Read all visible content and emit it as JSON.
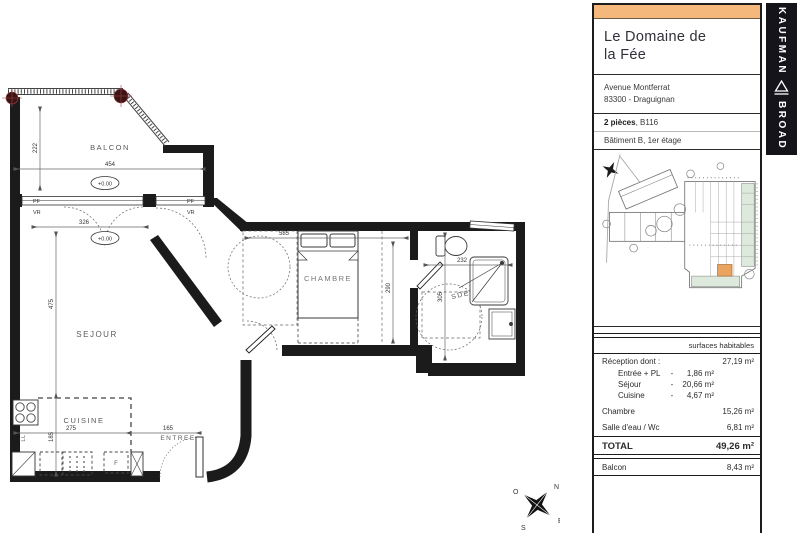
{
  "panel": {
    "title_line1": "Le Domaine de",
    "title_line2": "la Fée",
    "address_line1": "Avenue Montferrat",
    "address_line2": "83300 - Draguignan",
    "unit_type": "2 pièces",
    "unit_ref": ", B116",
    "unit_location": "Bâtiment B, 1er étage",
    "accent_color": "#F4B77C"
  },
  "brand": {
    "top": "KAUFMAN",
    "bottom": "BROAD"
  },
  "surfaces": {
    "header": "surfaces habitables",
    "reception": {
      "label": "Réception dont :",
      "value": "27,19 m²"
    },
    "sub": [
      {
        "label": "Entrée + PL",
        "dash": "-",
        "value": "1,86 m²"
      },
      {
        "label": "Séjour",
        "dash": "-",
        "value": "20,66 m²"
      },
      {
        "label": "Cuisine",
        "dash": "-",
        "value": "4,67 m²"
      }
    ],
    "rows": [
      {
        "label": "Chambre",
        "value": "15,26 m²"
      },
      {
        "label": "Salle d'eau / Wc",
        "value": "6,81 m²"
      }
    ],
    "total": {
      "label": "TOTAL",
      "value": "49,26 m²"
    },
    "balcony": {
      "label": "Balcon",
      "value": "8,43 m²"
    }
  },
  "floorplan": {
    "room_balcon": "BALCON",
    "room_sejour": "SEJOUR",
    "room_cuisine": "CUISINE",
    "room_entree": "ENTREE",
    "room_chambre": "CHAMBRE",
    "room_sde": "SDE",
    "dim_balcon_w": "454",
    "dim_balcon_d": "222",
    "dim_sejour_w": "326",
    "dim_sejour_d": "475",
    "dim_cuisine_w": "275",
    "dim_cuisine_d": "185",
    "dim_entree_w": "165",
    "dim_chambre_w": "585",
    "dim_chambre_d": "290",
    "dim_sde_w": "232",
    "dim_sde_d": "305",
    "level_balcon": "+0.00",
    "level_sejour": "+0.00",
    "pf1": "PF",
    "pf2": "PF",
    "vr1": "VR",
    "vr2": "VR",
    "ll": "LL",
    "f": "F",
    "compass_n": "N",
    "compass_s": "S",
    "compass_e": "E",
    "compass_o": "O"
  }
}
